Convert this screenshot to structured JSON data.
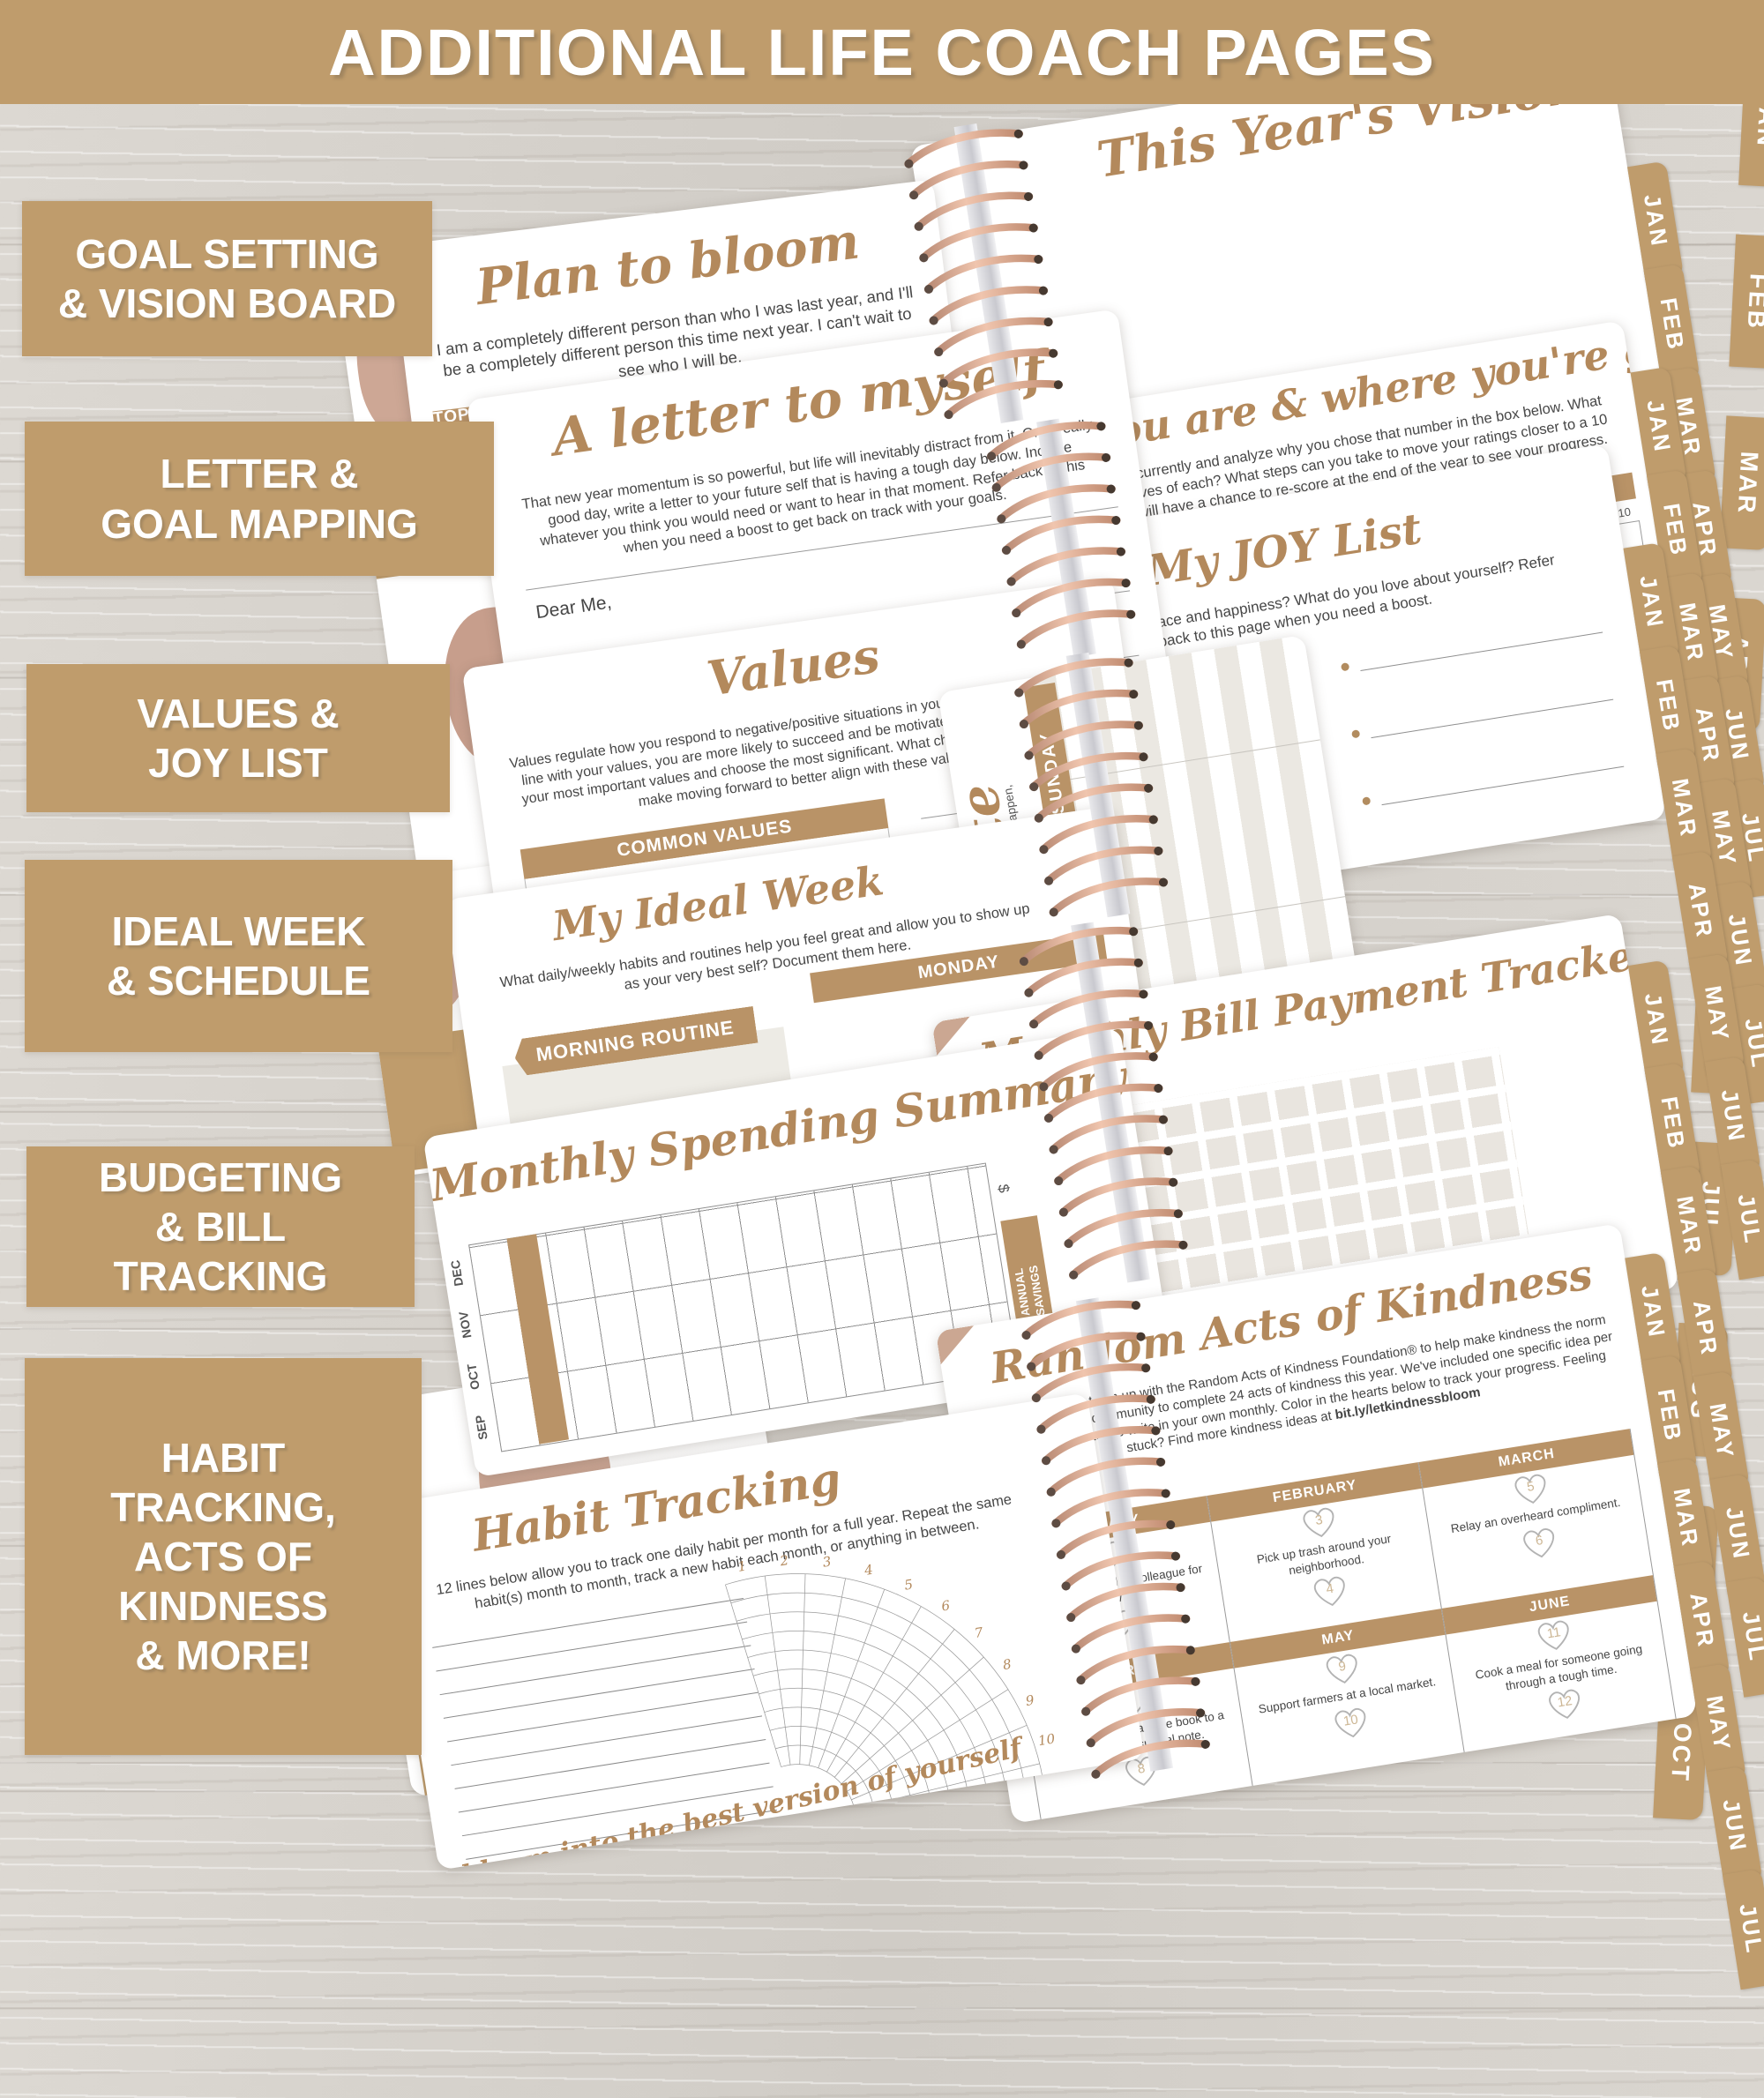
{
  "banner": {
    "title": "ADDITIONAL LIFE COACH PAGES"
  },
  "labels": [
    {
      "text": "GOAL SETTING\n& VISION BOARD"
    },
    {
      "text": "LETTER &\nGOAL MAPPING"
    },
    {
      "text": "VALUES &\nJOY LIST"
    },
    {
      "text": "IDEAL WEEK\n& SCHEDULE"
    },
    {
      "text": "BUDGETING\n& BILL\nTRACKING"
    },
    {
      "text": "HABIT\nTRACKING,\nACTS OF\nKINDNESS\n& MORE!"
    }
  ],
  "tabs": {
    "sheet": [
      "JAN",
      "FEB",
      "MAR",
      "APR",
      "MAY",
      "JUN",
      "JUL"
    ],
    "edge": [
      "JAN",
      "FEB",
      "MAR",
      "APR",
      "MAY",
      "JUN",
      "JUL",
      "AUG",
      "SEP",
      "OCT"
    ]
  },
  "pages": {
    "plan": {
      "title": "Plan to bloom",
      "body": "I am a completely different person than who I was last year, and I'll be a completely different person this time next year. I can't wait to see who I will be.",
      "col1": "TOP 5 GOALS FOR THE YEAR",
      "col2": "THINGS TO LOOK FORWARD TO",
      "first": "1."
    },
    "visions": {
      "title": "This Year's Visions"
    },
    "where": {
      "title": "Where you are & where you're going",
      "body": "Rate each area of your life currently and analyze why you chose that number in the box below. What are the positives and negatives of each? What steps can you take to move your ratings closer to a 10 (if not already there)? You will have a chance to re-score at the end of the year to see your progress.",
      "sections": [
        "PERSONAL GROWTH",
        "RELATIONSHIPS",
        "HEALTH & FITNESS"
      ],
      "scale": [
        "1",
        "2",
        "3",
        "4",
        "5",
        "6",
        "7",
        "8",
        "9",
        "10"
      ]
    },
    "letter": {
      "title": "A letter to myself",
      "body": "That new year momentum is so powerful, but life will inevitably distract from it. On a really good day, write a letter to your future self that is having a tough day below. Include whatever you think you would need or want to hear in that moment. Refer back to this when you need a boost to get back on track with your goals.",
      "salutation": "Dear Me,"
    },
    "values": {
      "title": "Values",
      "body": "Values regulate how you respond to negative/positive situations in your life. If your goals are in line with your values, you are more likely to succeed and be motivated. Circle/write some of your most important values and choose the most significant. What changes are you going to make moving forward to better align with these values?",
      "header": "COMMON VALUES",
      "columns": [
        [
          "Accountability",
          "Ambition",
          "Authenticity"
        ],
        [
          "Family",
          "Generosity",
          "Gratitude"
        ],
        [
          "Loyalty",
          "Openness",
          "Positivity"
        ]
      ]
    },
    "joy": {
      "title": "My JOY List",
      "body": "What brings you peace and happiness? What do you love about yourself? Refer back to this page when you need a boost."
    },
    "week": {
      "title": "My Ideal Week",
      "body": "What daily/weekly habits and routines help you feel great and allow you to show up as your very best self? Document them here.",
      "routine": "MORNING ROUTINE",
      "days": [
        "MONDAY",
        "TUESDAY"
      ]
    },
    "schedule": {
      "script": "late",
      "caption_1": "from the previous page. Life will happen,",
      "caption_2": "Print more at bloomplanners.com.",
      "day_1": "SUNDAY",
      "day_2": "SATURDAY"
    },
    "spending": {
      "title": "Monthly Spending Summary",
      "months": [
        "DEC",
        "NOV",
        "OCT",
        "SEP"
      ],
      "savings": "ANNUAL\nSAVINGS",
      "currency": "$"
    },
    "bills": {
      "title": "Monthly Bill Payment Tracker",
      "months": [
        "DEC",
        "NOV",
        "OCT",
        "SEP",
        "AUG",
        "JUL",
        "JUN"
      ]
    },
    "habit": {
      "title": "Habit Tracking",
      "body": "12 lines below allow you to track one daily habit per month for a full year. Repeat the same habit(s) month to month, track a new habit each month, or anything in between.",
      "numbers": [
        "1",
        "2",
        "3",
        "4",
        "5",
        "6",
        "7",
        "8",
        "9",
        "10",
        "11",
        "12"
      ],
      "footer": "bloom into the best version of yourself"
    },
    "kindness": {
      "title": "Random Acts of Kindness",
      "body": "bloom is proud to team up with the Random Acts of Kindness Foundation® to help make kindness the norm and challenge our community to complete 24 acts of kindness this year. We've included one specific idea per month plus a space to write in your own monthly. Color in the hearts below to track your progress. Feeling stuck? Find more kindness ideas at ",
      "link": "bit.ly/letkindnessbloom",
      "months": [
        {
          "name": "JANUARY",
          "heart_1": "1",
          "text": "Invite a new friend or colleague for coffee/tea.",
          "heart_2": "2"
        },
        {
          "name": "FEBRUARY",
          "heart_1": "3",
          "text": "Pick up trash around your neighborhood.",
          "heart_2": "4"
        },
        {
          "name": "MARCH",
          "heart_1": "5",
          "text": "Relay an overheard compliment.",
          "heart_2": "6"
        },
        {
          "name": "APRIL",
          "heart_1": "7",
          "text": "Gift or lend your favorite book to a friend with a special note.",
          "heart_2": "8"
        },
        {
          "name": "MAY",
          "heart_1": "9",
          "text": "Support farmers at a local market.",
          "heart_2": "10"
        },
        {
          "name": "JUNE",
          "heart_1": "11",
          "text": "Cook a meal for someone going through a tough time.",
          "heart_2": "12"
        }
      ]
    }
  },
  "colors": {
    "tan": "#bf9c6c",
    "gold": "#b3895c",
    "coil": "#d9a58c",
    "body_text": "#474747"
  }
}
